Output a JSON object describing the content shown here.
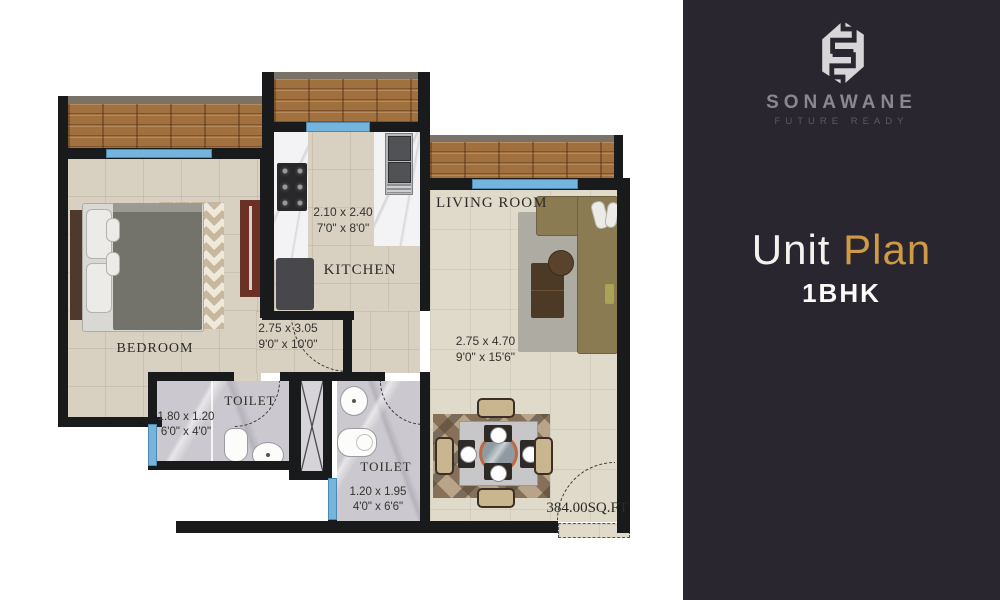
{
  "brand": {
    "name": "SONAWANE",
    "tagline": "FUTURE READY",
    "title_primary": "Unit",
    "title_accent": "Plan",
    "unit_type": "1BHK",
    "accent_color": "#cf9a45",
    "panel_bg": "#2a2630"
  },
  "plan": {
    "total_area": "384.00SQ.FT",
    "rooms": [
      {
        "id": "bedroom",
        "label": "BEDROOM",
        "dim_m": "2.75 x 3.05",
        "dim_ft": "9'0\" x 10'0\""
      },
      {
        "id": "kitchen",
        "label": "KITCHEN",
        "dim_m": "2.10 x 2.40",
        "dim_ft": "7'0\" x 8'0\""
      },
      {
        "id": "living-room",
        "label": "LIVING ROOM",
        "dim_m": "2.75 x 4.70",
        "dim_ft": "9'0\" x 15'6\""
      },
      {
        "id": "toilet-1",
        "label": "TOILET",
        "dim_m": "1.80 x 1.20",
        "dim_ft": "6'0\" x 4'0\""
      },
      {
        "id": "toilet-2",
        "label": "TOILET",
        "dim_m": "1.20 x 1.95",
        "dim_ft": "4'0\" x 6'6\""
      }
    ],
    "colors": {
      "wall": "#191a1c",
      "window_blue": "#74b5dd",
      "deck_wood": "#a0703f",
      "floor_tile": "#d8d1c2"
    }
  }
}
